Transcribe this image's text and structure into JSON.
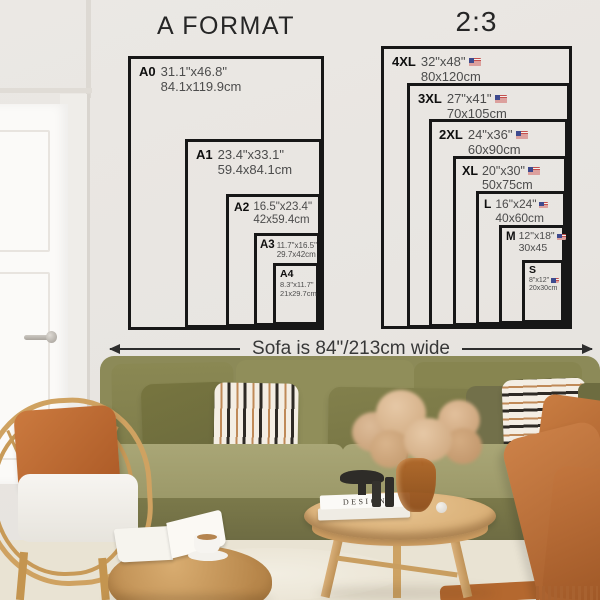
{
  "left_chart": {
    "title": "A FORMAT",
    "sizes": [
      {
        "label": "A0",
        "inches": "31.1\"x46.8\"",
        "cm": "84.1x119.9cm"
      },
      {
        "label": "A1",
        "inches": "23.4\"x33.1\"",
        "cm": "59.4x84.1cm"
      },
      {
        "label": "A2",
        "inches": "16.5\"x23.4\"",
        "cm": "42x59.4cm"
      },
      {
        "label": "A3",
        "inches": "11.7\"x16.5\"",
        "cm": "29.7x42cm"
      },
      {
        "label": "A4",
        "inches": "8.3\"x11.7\"",
        "cm": "21x29.7cm"
      }
    ]
  },
  "right_chart": {
    "title": "2:3",
    "flag_icon": "us-flag-icon",
    "sizes": [
      {
        "label": "4XL",
        "inches": "32\"x48\"",
        "cm": "80x120cm"
      },
      {
        "label": "3XL",
        "inches": "27\"x41\"",
        "cm": "70x105cm"
      },
      {
        "label": "2XL",
        "inches": "24\"x36\"",
        "cm": "60x90cm"
      },
      {
        "label": "XL",
        "inches": "20\"x30\"",
        "cm": "50x75cm"
      },
      {
        "label": "L",
        "inches": "16\"x24\"",
        "cm": "40x60cm"
      },
      {
        "label": "M",
        "inches": "12\"x18\"",
        "cm": "30x45"
      },
      {
        "label": "S",
        "inches": "8\"x12\"",
        "cm": "20x30cm"
      }
    ]
  },
  "sofa_note": {
    "text": "Sofa is 84\"/213cm wide"
  },
  "decor": {
    "book_title": "DESIGN"
  },
  "colors": {
    "wall": "#e9e6e2",
    "line": "#171717",
    "dims_text": "#4c4c4c",
    "sofa_olive": "#8c8a58",
    "terracotta": "#b96f37",
    "rattan": "#cfa261"
  }
}
